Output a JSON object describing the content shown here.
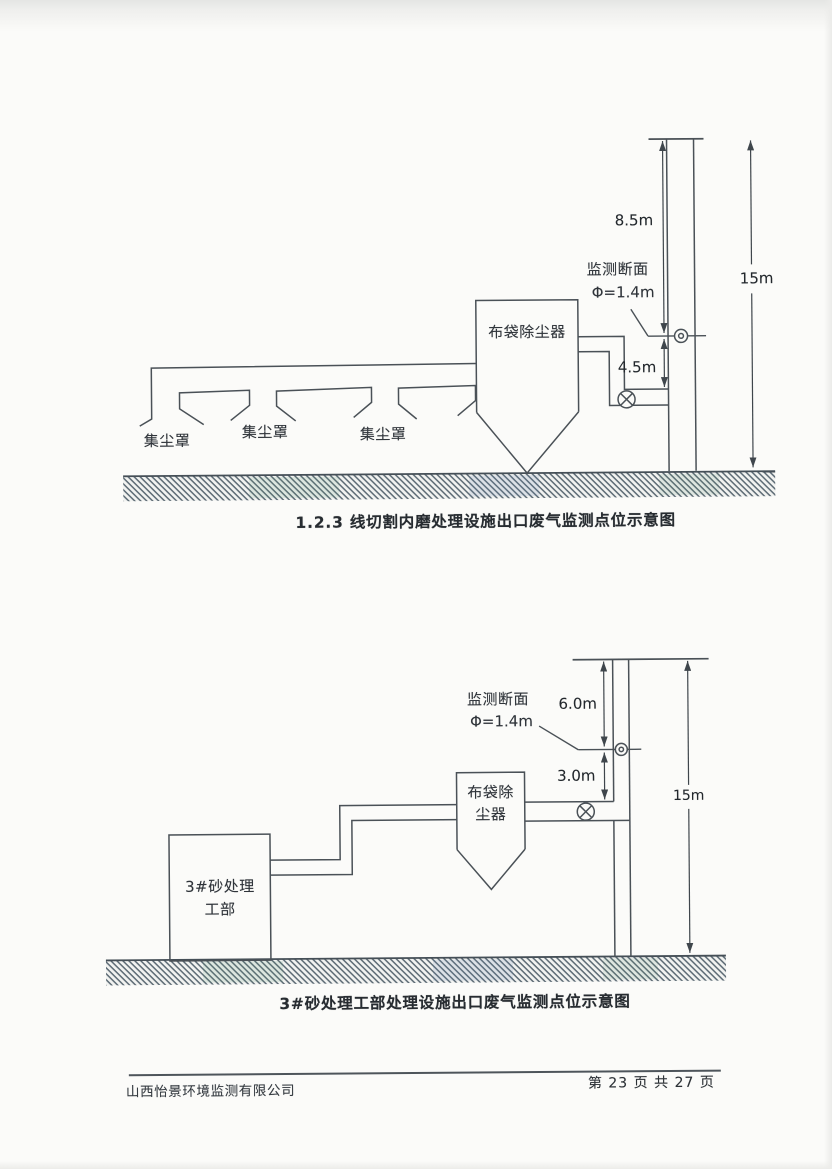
{
  "diagram1": {
    "caption": "1.2.3 线切割内磨处理设施出口废气监测点位示意图",
    "collector_label": "布袋除尘器",
    "hood_labels": [
      "集尘罩",
      "集尘罩",
      "集尘罩"
    ],
    "monitor_section_line1": "监测断面",
    "monitor_section_line2": "Φ=1.4m",
    "dim_upper": "8.5m",
    "dim_lower": "4.5m",
    "dim_total": "15m"
  },
  "diagram2": {
    "caption": "3#砂处理工部处理设施出口废气监测点位示意图",
    "collector_label_line1": "布袋除",
    "collector_label_line2": "尘器",
    "workshop_label_line1": "3#砂处理",
    "workshop_label_line2": "工部",
    "monitor_section_line1": "监测断面",
    "monitor_section_line2": "Φ=1.4m",
    "dim_upper": "6.0m",
    "dim_lower": "3.0m",
    "dim_total": "15m"
  },
  "footer": {
    "company": "山西怡景环境监测有限公司",
    "page_info": "第 23 页 共 27 页"
  },
  "colors": {
    "line": "#4a5157",
    "text": "#2f343a",
    "hatch": "#5c6a74",
    "paper": "#fbfbf9"
  }
}
